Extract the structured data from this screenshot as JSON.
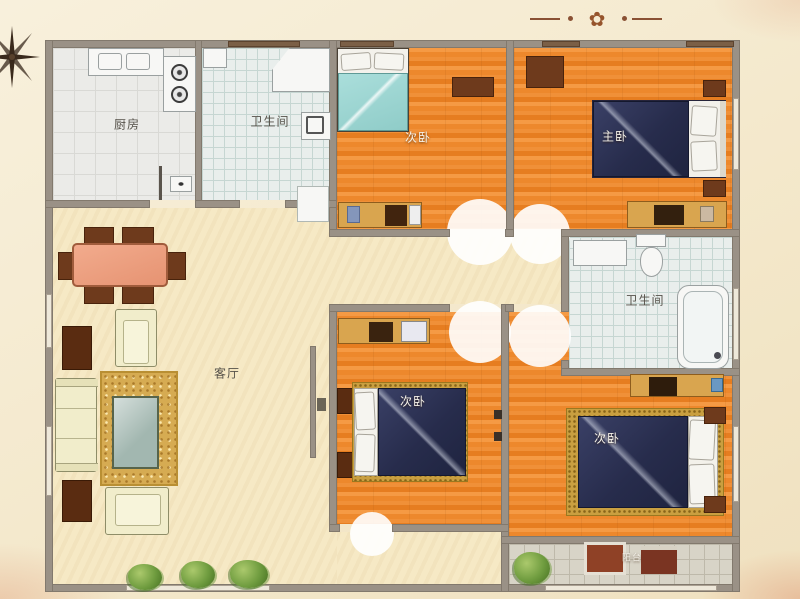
{
  "title": "apartment-floor-plan",
  "rooms": [
    {
      "id": "kitchen",
      "label": "厨房"
    },
    {
      "id": "bathroom-top",
      "label": "卫生间"
    },
    {
      "id": "bedroom-top-middle",
      "label": "次卧"
    },
    {
      "id": "bedroom-top-right",
      "label": "主卧"
    },
    {
      "id": "bathroom-right",
      "label": "卫生间"
    },
    {
      "id": "living-room",
      "label": "客厅"
    },
    {
      "id": "bedroom-bottom-middle",
      "label": "次卧"
    },
    {
      "id": "bedroom-bottom-right",
      "label": "次卧"
    },
    {
      "id": "balcony",
      "label": "阳台"
    }
  ],
  "decor": {
    "compass_icon": "compass-rose",
    "ornament_icon": "floral-divider"
  },
  "colors": {
    "wall": "#9a9186",
    "floor_wood_orange": "#ee8a2b",
    "floor_cream": "#f6e9c5",
    "tile_gray": "#ebebe8",
    "tile_blue": "#e9eeec",
    "tile_balcony": "#d8d4c7",
    "bed_blanket_navy": "#2a2f50",
    "bed_blanket_teal": "#9ed8d4",
    "furniture_brown": "#6e3a1c",
    "dresser_tan": "#d9a54f",
    "dining_table_salmon": "#efa183",
    "rug_gold": "#d6ab52",
    "sofa_cream": "#f1edcb"
  }
}
